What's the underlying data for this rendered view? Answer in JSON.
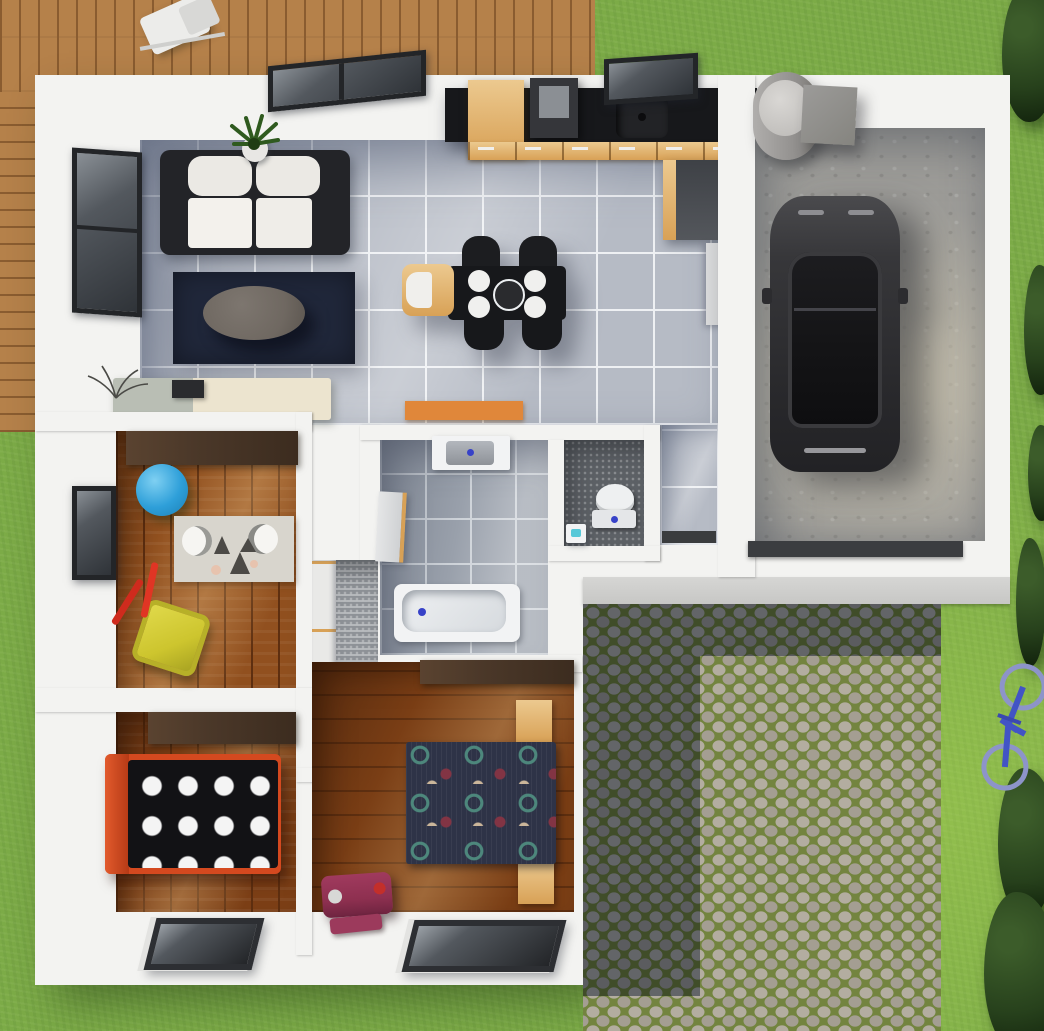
{
  "scene": {
    "kind": "3d-rendered-floor-plan",
    "view": "top-down",
    "width_px": 1044,
    "height_px": 1031
  },
  "palette": {
    "grass": "#7cab47",
    "deck_wood": "#b5814a",
    "deck_seam": "#8a5c30",
    "house_white": "#f3f3f1",
    "step": "#c7c7c5",
    "tile": "#b6bbc5",
    "tile_grout": "#eef0f3",
    "bath_tile": "#99a0ab",
    "bath_grout": "#cdd2d8",
    "speckle": "#5d6166",
    "speckle_light": "#8e9297",
    "wood_a": "#91501f",
    "wood_b": "#7c3f16",
    "wood_dark_line": "#5e2f10",
    "walnut": "#4b3829",
    "oak": "#d8a156",
    "oak_light": "#ecc98f",
    "counter_black": "#17181b",
    "counter_gray": "#3e4146",
    "rug_navy": "#20273a",
    "sofa_frame": "#232428",
    "cushion_white": "#ebe9e4",
    "coffee_table": "#6f6861",
    "orange": "#e0873a",
    "ball_blue": "#2e9fd9",
    "toy_yellow": "#cdc52e",
    "toy_red": "#cf2b1d",
    "bed_red": "#d4491f",
    "duvet_black": "#121215",
    "dot_white": "#f4f4f4",
    "duvet_navy": "#2e3347",
    "dot_teal": "#4d877c",
    "dot_maroon": "#823444",
    "dot_beige": "#cbb69a",
    "maroon": "#8e3050",
    "play_rug": "#d8d5cd",
    "concrete": "#9e9d99",
    "car_body": "#333336",
    "car_glass": "#141416",
    "cobble_stone": "#b3ada0",
    "cobble_stone2": "#a49e92",
    "cobble_moss": "#73843f",
    "shadow_blue": "rgba(36,52,82,0.52)",
    "hedge_dark": "#27411c",
    "hedge_mid": "#3c5c2a",
    "bike_blue": "#4254c5",
    "window_frame": "#232528",
    "glass": "#53585e",
    "glass_dark": "#2f3338",
    "white_fixture": "#f2f3f4",
    "dot_blue": "#3742c8",
    "garage_door": "#3b3d40"
  },
  "rooms": [
    {
      "name": "living-room",
      "furniture": [
        "sofa",
        "area-rug",
        "coffee-table",
        "potted-plant",
        "sideboard",
        "window",
        "skylight"
      ]
    },
    {
      "name": "kitchen",
      "furniture": [
        "l-shaped-counter",
        "sink",
        "cooktop-hood",
        "tall-cabinet",
        "window"
      ]
    },
    {
      "name": "dining-area",
      "furniture": [
        "dining-table",
        "four-chairs",
        "four-plates",
        "serving-bowl",
        "high-chair"
      ]
    },
    {
      "name": "nursery",
      "furniture": [
        "wardrobe",
        "gym-ball",
        "play-rug",
        "toy-wheelbarrow",
        "window"
      ]
    },
    {
      "name": "hall-closet",
      "furniture": [
        "wardrobe-units"
      ]
    },
    {
      "name": "bathroom",
      "furniture": [
        "vanity-sink",
        "bathtub",
        "door"
      ]
    },
    {
      "name": "wc",
      "furniture": [
        "toilet",
        "hand-basin"
      ]
    },
    {
      "name": "entry-hall",
      "furniture": [
        "door-mat",
        "orange-runner"
      ]
    },
    {
      "name": "garage",
      "furniture": [
        "car",
        "water-heater",
        "storage-box",
        "garage-door"
      ]
    },
    {
      "name": "bedroom-1",
      "furniture": [
        "red-single-bed",
        "polka-dot-duvet",
        "wardrobe",
        "roof-window"
      ]
    },
    {
      "name": "bedroom-2",
      "furniture": [
        "double-bed",
        "patterned-duvet",
        "two-nightstands",
        "wardrobe",
        "suitcase",
        "roof-window"
      ]
    },
    {
      "name": "driveway",
      "features": [
        "cobblestones",
        "house-shadow",
        "entrance-step"
      ]
    },
    {
      "name": "terrace",
      "features": [
        "wood-decking",
        "patio-chair"
      ]
    },
    {
      "name": "lawn",
      "features": [
        "grass",
        "hedges",
        "bicycle"
      ]
    }
  ]
}
